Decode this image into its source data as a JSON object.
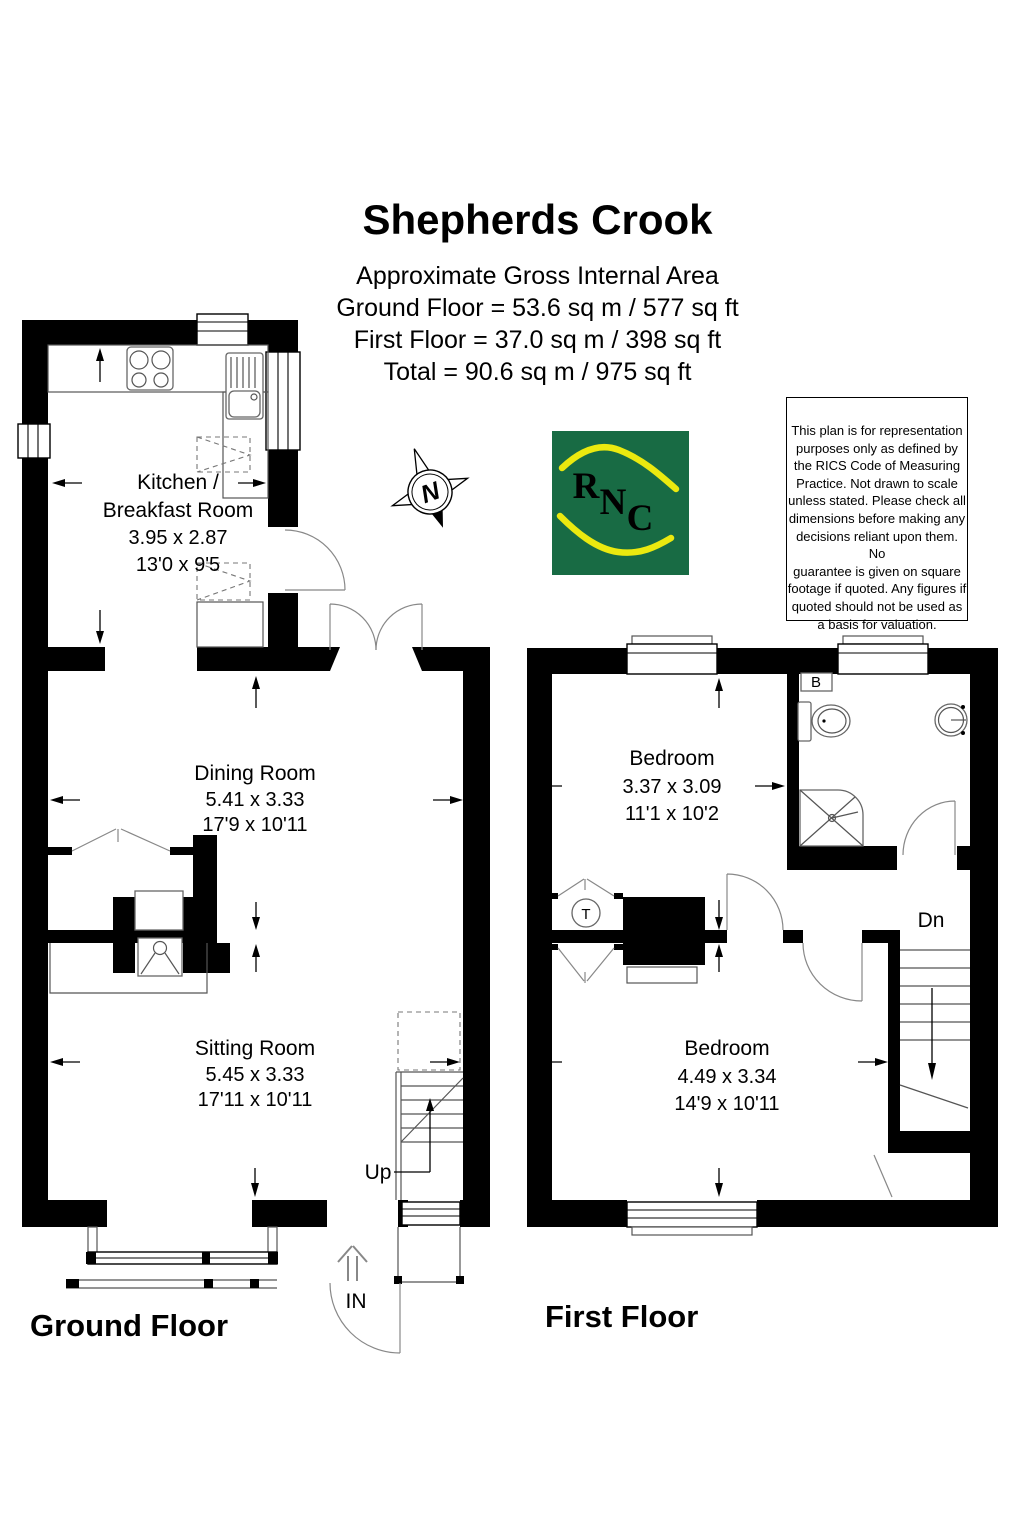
{
  "header": {
    "title": "Shepherds Crook",
    "area_heading": "Approximate Gross Internal Area",
    "area_ground": "Ground Floor = 53.6 sq m / 577 sq ft",
    "area_first": "First Floor = 37.0 sq m / 398 sq ft",
    "area_total": "Total = 90.6 sq m / 975 sq ft"
  },
  "compass": {
    "north_label": "N"
  },
  "logo": {
    "letters": [
      "R",
      "N",
      "C"
    ],
    "green": "#186b44",
    "yellow": "#ebe90f"
  },
  "disclaimer": {
    "text": "This plan is for representation\npurposes only as defined by\nthe RICS Code of Measuring\nPractice. Not drawn to scale\nunless stated. Please check all\ndimensions before making any\ndecisions reliant upon them. No\nguarantee is given on square\nfootage if quoted. Any figures if\nquoted should not be used as\na basis for valuation."
  },
  "ground_floor": {
    "label": "Ground Floor",
    "rooms": {
      "kitchen": {
        "name_line1": "Kitchen /",
        "name_line2": "Breakfast Room",
        "metric": "3.95 x 2.87",
        "imperial": "13'0 x 9'5"
      },
      "dining": {
        "name": "Dining Room",
        "metric": "5.41 x 3.33",
        "imperial": "17'9 x 10'11"
      },
      "sitting": {
        "name": "Sitting Room",
        "metric": "5.45 x 3.33",
        "imperial": "17'11 x 10'11"
      }
    },
    "annotations": {
      "up": "Up",
      "entrance": "IN"
    }
  },
  "first_floor": {
    "label": "First Floor",
    "rooms": {
      "bedroom1": {
        "name": "Bedroom",
        "metric": "3.37 x 3.09",
        "imperial": "11'1 x 10'2"
      },
      "bedroom2": {
        "name": "Bedroom",
        "metric": "4.49 x 3.34",
        "imperial": "14'9 x 10'11"
      }
    },
    "annotations": {
      "down": "Dn",
      "boiler": "B",
      "tank": "T"
    }
  },
  "colors": {
    "walls": "#000000",
    "background": "#ffffff"
  }
}
